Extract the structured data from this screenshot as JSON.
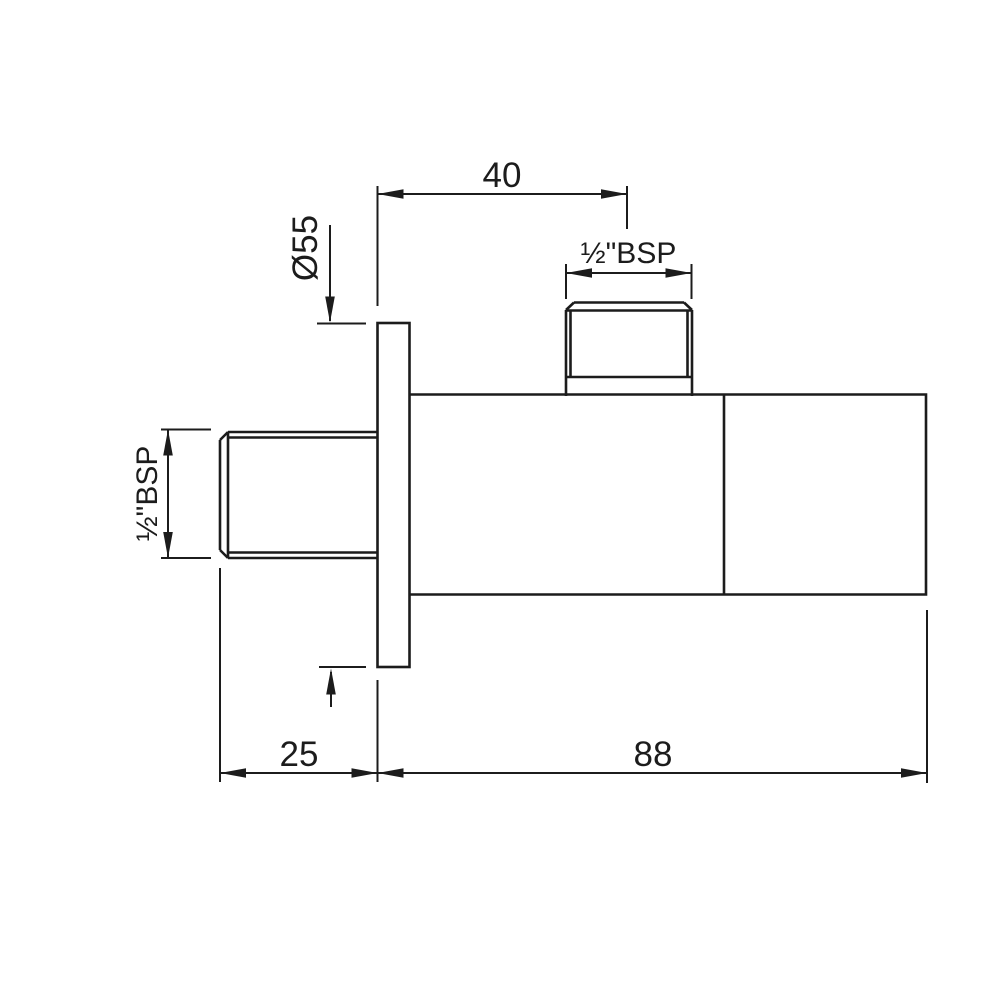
{
  "drawing": {
    "dimensions": {
      "top_offset": "40",
      "flange_diameter": "Ø55",
      "top_thread": "½\"BSP",
      "side_thread": "½\"BSP",
      "wall_distance": "25",
      "body_length": "88"
    },
    "colors": {
      "line": "#1c1c1c",
      "background": "#ffffff"
    }
  }
}
